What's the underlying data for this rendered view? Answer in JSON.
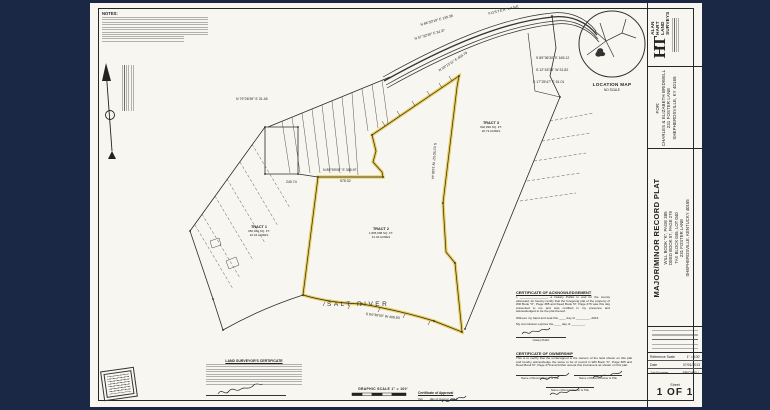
{
  "colors": {
    "background": "#1a2845",
    "paper": "#f7f6f1",
    "ink": "#26262a",
    "highlight": "#e8c53e"
  },
  "title_block": {
    "firm": {
      "monogram": "HT",
      "name_lines": [
        "ALAN",
        "HART",
        "LAND",
        "SURVEYS"
      ]
    },
    "client": {
      "for_label": "FOR:",
      "name": "CHARLES & ELIZABETH BRIDWELL",
      "address1": "231 FOSTER LANE",
      "address2": "SHEPHERDSVILLE, KY 40165"
    },
    "plat": {
      "title": "MAJOR/MINOR RECORD PLAT",
      "refs": [
        "WILL BOOK \"K\", PAGE 385",
        "DEED BOOK 57, PAGE 279",
        "TAX BLOCK 045, LOT 040",
        "231 FOSTER LANE",
        "SHEPHERDSVILLE, KENTUCKY 40165"
      ]
    },
    "info_rows": [
      {
        "label": "Reference Scale",
        "value": "1\" = 100'"
      },
      {
        "label": "Date",
        "value": "07/01/2013"
      },
      {
        "label": "Job Number",
        "value": "BRIDWELL"
      }
    ],
    "sheet_label": "Sheet",
    "sheet_number": "1 OF 1"
  },
  "drawing": {
    "notes_heading": "NOTES:",
    "location_map": {
      "title": "LOCATION MAP",
      "subtitle": "NO SCALE"
    },
    "road_label": "FOSTER LANE",
    "river_label": "SALT RIVER",
    "graphic_scale_label": "GRAPHIC SCALE  1\" = 100'",
    "tracts": [
      {
        "name": "TRACT 1",
        "line2": "960,062 SQ. FT.",
        "line3": "22.04 ACRES"
      },
      {
        "name": "TRACT 2",
        "line2": "1,805,998 SQ. FT.",
        "line3": "41.46 ACRES"
      },
      {
        "name": "TRACT 3",
        "line2": "902,999 SQ. FT.",
        "line3": "20.73 ACRES"
      }
    ],
    "bearing_labels": [
      "N 84°50'19\" E  130.38",
      "N 57°32'30\" E  34.37",
      "N 59°13'11\" E  404.79",
      "S 89°36'30\" E  165.12",
      "S 12°43'33\" W  31.82",
      "S 17°25'47\" E  51.01",
      "N 79°26'39\" E  31.46",
      "N 89°59'08\" E  308.97",
      "575.32",
      "240.74",
      "S 01°50'02\" W  1436.44",
      "S 84°38'00\" W  408.83"
    ],
    "certificates": {
      "acknowledgement": {
        "heading": "CERTIFICATE OF ACKNOWLEDGEMENT",
        "body": "I, ________________, a Notary Public in and for the county aforesaid, do hereby certify that the foregoing plat of the property of Will Book \"K\", Page 385 and Deed Book 57, Page 279 was this day presented to me and was certified in my presence and acknowledged to be the plat thereof.",
        "witness_line": "Witness my hand and seal this ____ day of ________, 2013.",
        "expires_line": "My commission expires the ____ day of ________.",
        "notary_label": "Notary Public"
      },
      "ownership": {
        "heading": "CERTIFICATE OF OWNERSHIP",
        "body": "This is to certify that the undersigned is the owners of the land shown on this plat and hereby acknowledge the same to be of record in Will Book \"K\", Page 385 and Deed Book 57, Page 279 and further accept this instrument as shown on this plat.",
        "owner_label": "Name of Record Owner & Title"
      },
      "surveyor": {
        "heading": "LAND SURVEYOR'S CERTIFICATE"
      },
      "approval": {
        "heading": "Certificate of Approval",
        "date_line": "this ___ day of August, 2013"
      }
    }
  }
}
